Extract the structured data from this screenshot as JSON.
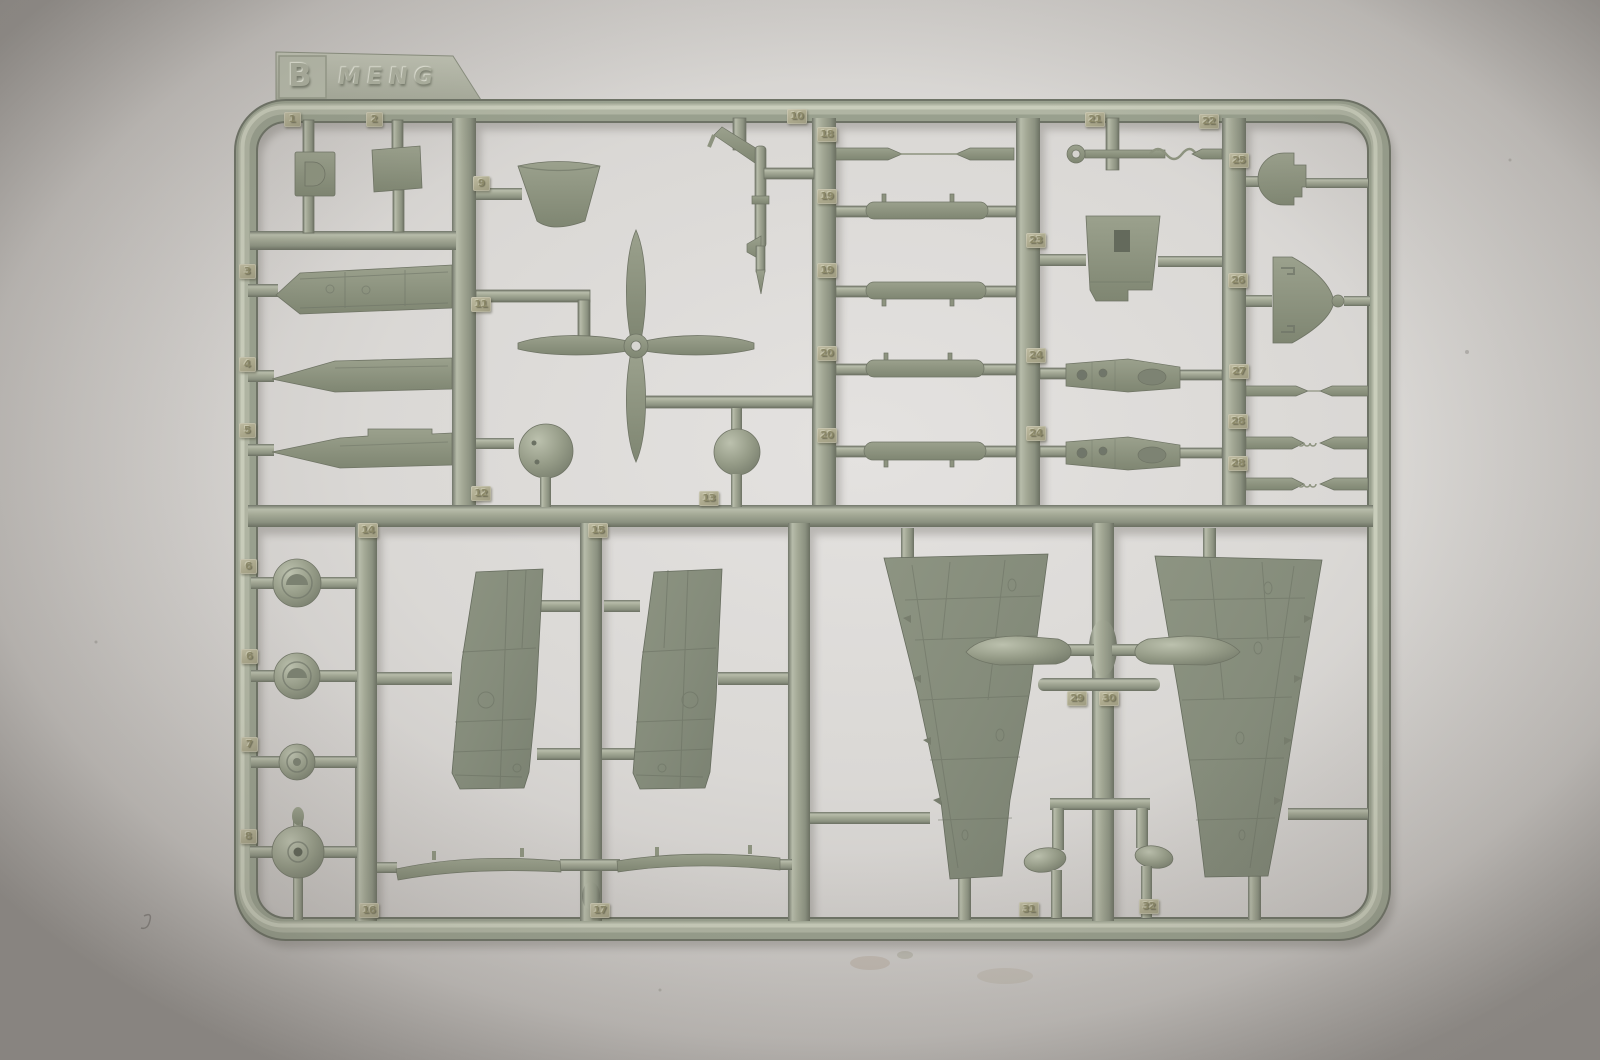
{
  "scene": {
    "subject": "photograph of an injection-molded plastic model kit sprue",
    "sprue_letter": "B",
    "brand": "MENG"
  },
  "tab": {
    "letter": "B",
    "brand": "MENG"
  },
  "tags": [
    {
      "label": "1"
    },
    {
      "label": "2"
    },
    {
      "label": "3"
    },
    {
      "label": "4"
    },
    {
      "label": "5"
    },
    {
      "label": "6"
    },
    {
      "label": "6"
    },
    {
      "label": "7"
    },
    {
      "label": "8"
    },
    {
      "label": "9"
    },
    {
      "label": "10"
    },
    {
      "label": "11"
    },
    {
      "label": "12"
    },
    {
      "label": "13"
    },
    {
      "label": "14"
    },
    {
      "label": "15"
    },
    {
      "label": "16"
    },
    {
      "label": "17"
    },
    {
      "label": "18"
    },
    {
      "label": "19"
    },
    {
      "label": "19"
    },
    {
      "label": "20"
    },
    {
      "label": "20"
    },
    {
      "label": "21"
    },
    {
      "label": "22"
    },
    {
      "label": "23"
    },
    {
      "label": "24"
    },
    {
      "label": "24"
    },
    {
      "label": "25"
    },
    {
      "label": "26"
    },
    {
      "label": "27"
    },
    {
      "label": "28"
    },
    {
      "label": "28"
    },
    {
      "label": "29"
    },
    {
      "label": "30"
    },
    {
      "label": "31"
    },
    {
      "label": "32"
    }
  ],
  "colors": {
    "plastic_runner": "#9da390",
    "plastic_part": "#8f9583",
    "plastic_tag": "#b3b098",
    "background": "#d7d5d2"
  }
}
